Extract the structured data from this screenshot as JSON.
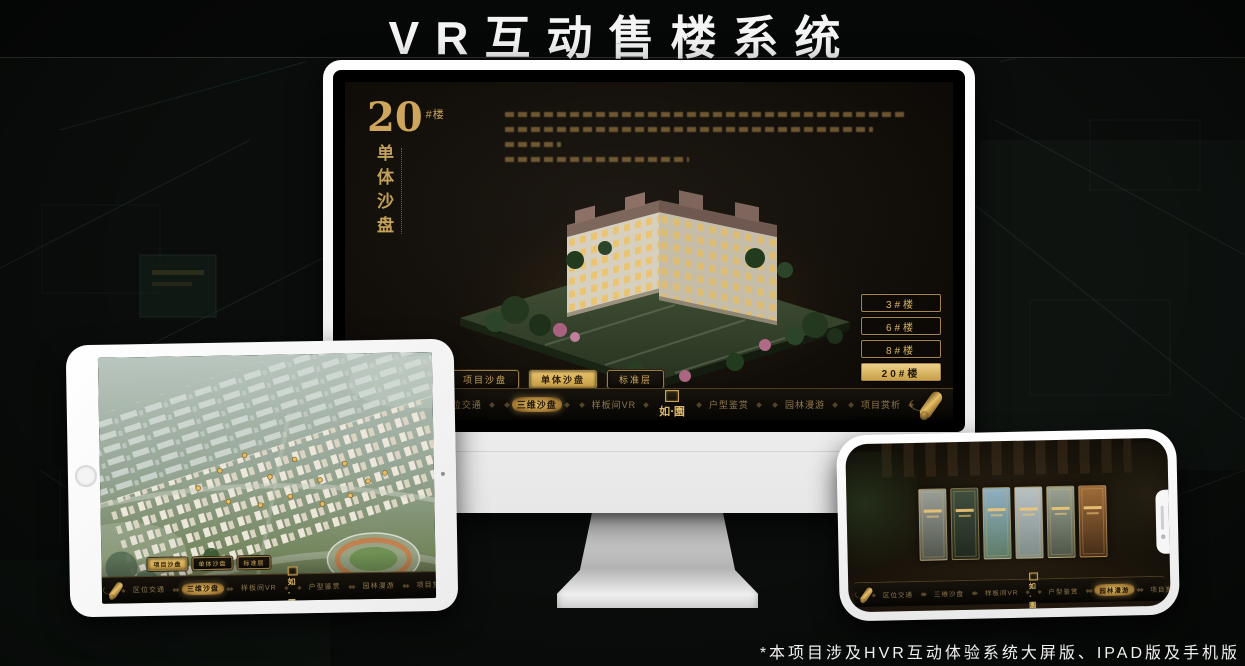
{
  "header": {
    "title": "VR互动售楼系统"
  },
  "footnote": "*本项目涉及HVR互动体验系统大屏版、IPAD版及手机版",
  "brand": {
    "logo_text": "如·園"
  },
  "colors": {
    "gold": "#d9b563",
    "page_bg": "#0a0d0b",
    "screen_bg": "#14100b"
  },
  "desktop_app": {
    "headline_number": "20",
    "headline_unit": "#楼",
    "headline_vertical": "单体沙盘",
    "floor_buttons": [
      {
        "label": "3#楼"
      },
      {
        "label": "6#楼"
      },
      {
        "label": "8#楼"
      },
      {
        "label": "20#楼",
        "selected": true
      }
    ],
    "sub_tabs": [
      {
        "label": "项目沙盘"
      },
      {
        "label": "单体沙盘",
        "selected": true
      },
      {
        "label": "标准层"
      }
    ],
    "nav_left": [
      {
        "label": "区位交通"
      },
      {
        "label": "三维沙盘",
        "selected": true
      },
      {
        "label": "样板间VR"
      }
    ],
    "nav_right": [
      {
        "label": "户型鉴赏"
      },
      {
        "label": "园林漫游"
      },
      {
        "label": "项目赏析"
      }
    ]
  },
  "tablet_app": {
    "sub_tabs": [
      {
        "label": "项目沙盘",
        "selected": true
      },
      {
        "label": "单体沙盘"
      },
      {
        "label": "标准层"
      }
    ],
    "nav_left": [
      {
        "label": "区位交通"
      },
      {
        "label": "三维沙盘",
        "selected": true
      },
      {
        "label": "样板间VR"
      }
    ],
    "nav_right": [
      {
        "label": "户型鉴赏"
      },
      {
        "label": "园林漫游"
      },
      {
        "label": "项目赏析"
      }
    ]
  },
  "phone_app": {
    "nav_left": [
      {
        "label": "区位交通"
      },
      {
        "label": "三维沙盘"
      },
      {
        "label": "样板间VR"
      }
    ],
    "nav_right": [
      {
        "label": "户型鉴赏"
      },
      {
        "label": "园林漫游",
        "selected": true
      },
      {
        "label": "项目赏析"
      }
    ],
    "scene_cards": [
      {
        "c1": "#9aa099",
        "c2": "#50544a"
      },
      {
        "c1": "#41503f",
        "c2": "#20281e"
      },
      {
        "c1": "#8fb0c4",
        "c2": "#5d7a66"
      },
      {
        "c1": "#b8c1c4",
        "c2": "#7e8b88"
      },
      {
        "c1": "#9aa393",
        "c2": "#4c5547"
      },
      {
        "c1": "#a06c3a",
        "c2": "#452c18"
      }
    ]
  }
}
